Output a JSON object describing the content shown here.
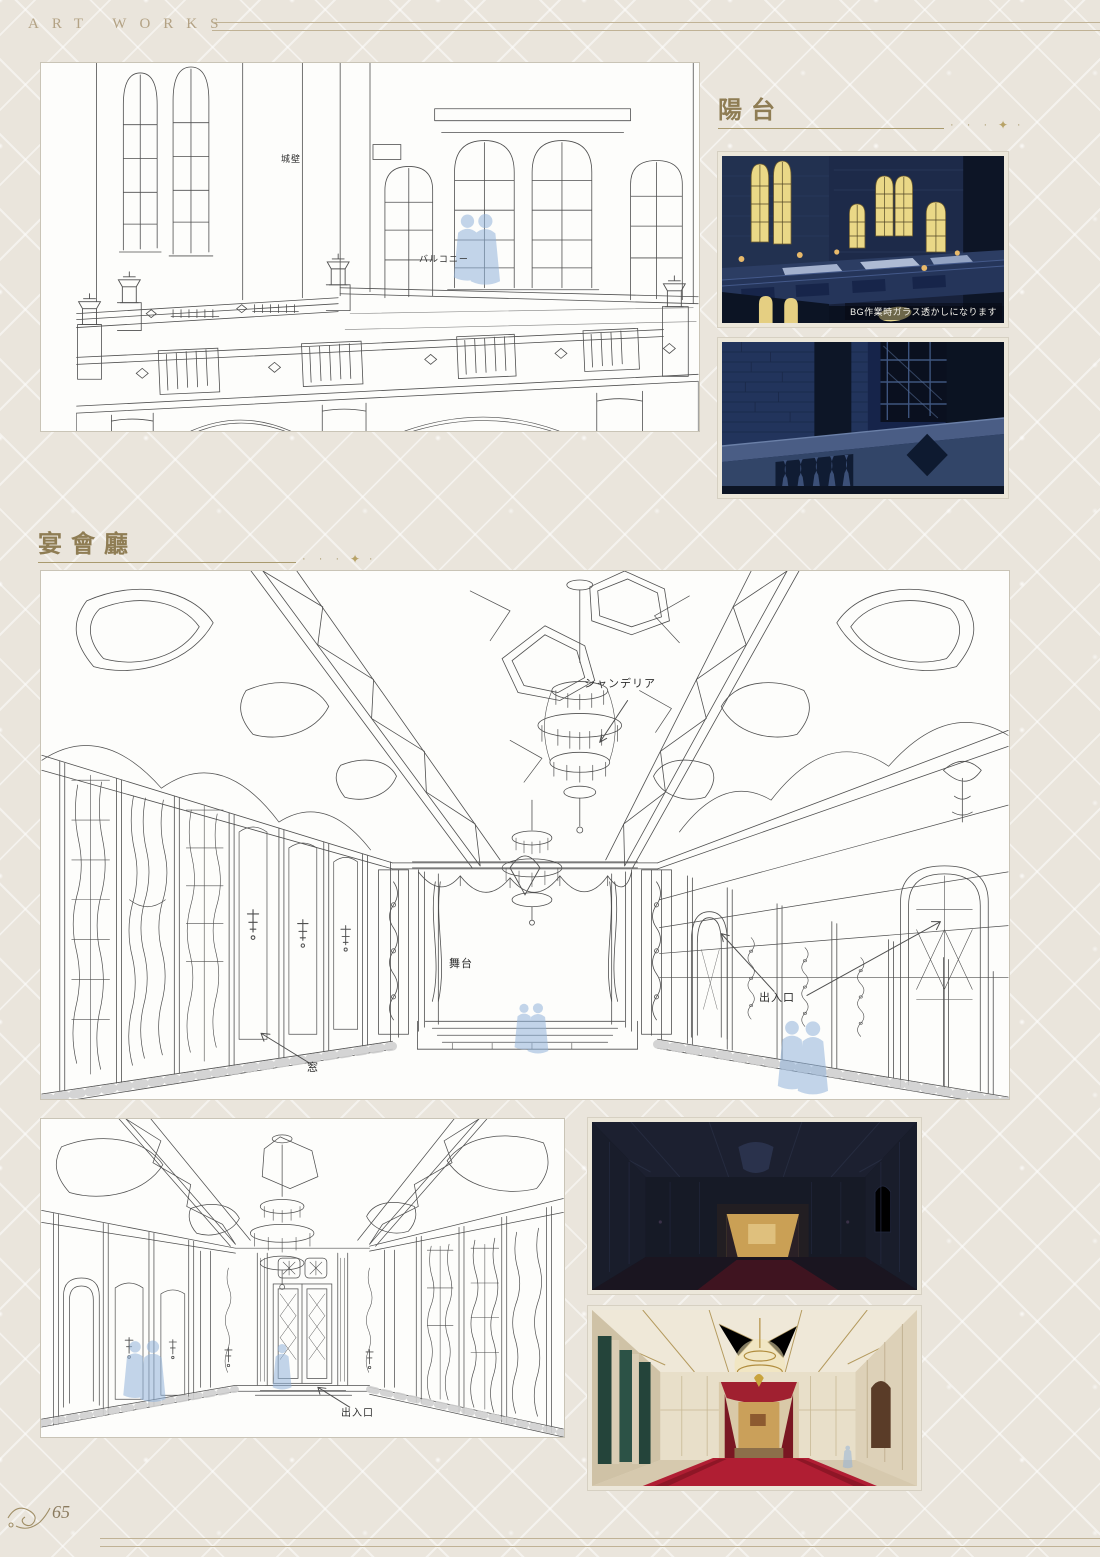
{
  "page": {
    "header": "ART WORKS",
    "page_number": "65"
  },
  "sections": {
    "balcony": {
      "title": "陽台",
      "dots": "· · · · ·",
      "diamond": "✦"
    },
    "banquet": {
      "title": "宴會廳",
      "dots": "· · · · ·",
      "diamond": "✦"
    }
  },
  "balcony_drawing": {
    "label_wall": "城壁",
    "label_balcony": "バルコニー"
  },
  "balcony_screens": {
    "caption": "BG作業時ガラス透かしになります"
  },
  "banquet_drawing": {
    "label_chandelier": "シャンデリア",
    "label_stage": "舞台",
    "label_window": "窓",
    "label_entrance": "出入口"
  },
  "banquet_drawing_small": {
    "label_entrance": "出入口"
  },
  "colors": {
    "accent_gold": "#9b8a60",
    "lineart_stroke": "#4f4f4f",
    "night_blue": "#1a2440",
    "window_glow": "#ecd98a",
    "carpet_red": "#b01e33",
    "figure_blue": "#8fb2dc"
  }
}
